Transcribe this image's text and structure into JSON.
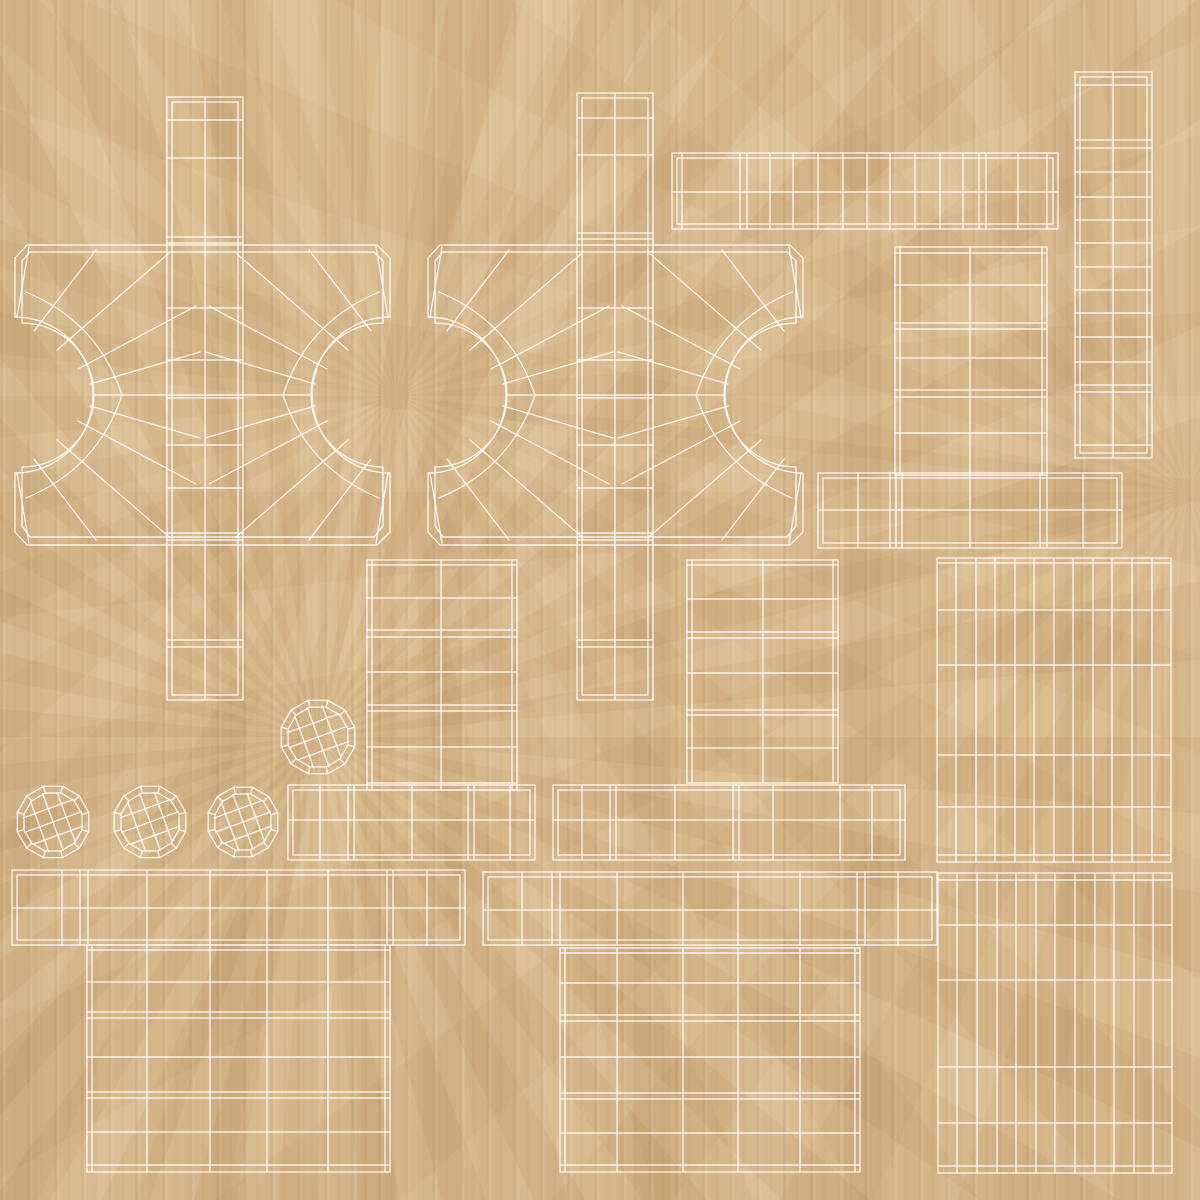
{
  "canvas": {
    "width": 1200,
    "height": 1200
  },
  "palette": {
    "wood_base": "#d8b88b",
    "wood_dark": "#c29b68",
    "wood_light": "#ecd8b0",
    "wire": "#ffffff"
  },
  "wireframe": {
    "stroke_width": 1.2,
    "groups": [
      {
        "name": "uv-strip-vertical-left",
        "els": [
          [
            "rect",
            167,
            97,
            76,
            603
          ],
          [
            "rect",
            172,
            102,
            66,
            593
          ],
          [
            "line",
            205,
            97,
            205,
            700
          ],
          [
            "hlines",
            [
              120,
              158,
              237,
              243,
              308,
              360,
              398,
              445,
              488,
              533,
              540,
              640,
              647
            ],
            167,
            243
          ]
        ]
      },
      {
        "name": "uv-plate-left",
        "els": [
          [
            "path",
            "M 27 245 L 377 245 L 390 258 L 390 317 A 78 78 0 0 0 390 473 L 390 532 L 377 545 L 27 545 L 15 532 L 15 473 A 78 78 0 0 0 15 317 L 15 258 Z"
          ],
          [
            "path",
            "M 30 252 L 374 252 L 383 261 L 383 323 A 72 72 0 0 0 383 467 L 383 526 L 374 537 L 30 537 L 22 526 L 22 467 A 72 72 0 0 0 22 323 L 22 261 Z"
          ],
          [
            "line",
            93,
            395,
            312,
            395
          ],
          [
            "line",
            17,
            317,
            29,
            247
          ],
          [
            "line",
            34,
            331,
            96,
            250
          ],
          [
            "line",
            57,
            350,
            168,
            254
          ],
          [
            "line",
            78,
            369,
            196,
            306
          ],
          [
            "line",
            90,
            384,
            200,
            352
          ],
          [
            "line",
            90,
            406,
            200,
            438
          ],
          [
            "line",
            78,
            421,
            196,
            484
          ],
          [
            "line",
            57,
            440,
            168,
            536
          ],
          [
            "line",
            34,
            459,
            96,
            540
          ],
          [
            "line",
            17,
            473,
            29,
            543
          ],
          [
            "path",
            "M 26 292 Q 98 322 122 395 Q 98 468 26 498"
          ],
          [
            "line",
            388,
            317,
            376,
            247
          ],
          [
            "line",
            371,
            331,
            309,
            250
          ],
          [
            "line",
            348,
            350,
            237,
            254
          ],
          [
            "line",
            327,
            369,
            209,
            306
          ],
          [
            "line",
            315,
            384,
            205,
            352
          ],
          [
            "line",
            315,
            406,
            205,
            438
          ],
          [
            "line",
            327,
            421,
            209,
            484
          ],
          [
            "line",
            348,
            440,
            237,
            536
          ],
          [
            "line",
            371,
            459,
            309,
            540
          ],
          [
            "line",
            388,
            473,
            376,
            543
          ],
          [
            "path",
            "M 379 292 Q 307 322 283 395 Q 307 468 379 498"
          ]
        ]
      },
      {
        "name": "uv-strip-vertical-center",
        "els": [
          [
            "rect",
            577,
            93,
            76,
            607
          ],
          [
            "rect",
            582,
            98,
            66,
            597
          ],
          [
            "line",
            615,
            93,
            615,
            700
          ],
          [
            "hlines",
            [
              118,
              155,
              233,
              239,
              308,
              360,
              398,
              445,
              488,
              533,
              540,
              640,
              647
            ],
            577,
            653
          ]
        ]
      },
      {
        "name": "uv-plate-center",
        "els": [
          [
            "path",
            "M 440 245 L 790 245 L 803 258 L 803 317 A 78 78 0 0 0 803 473 L 803 532 L 790 545 L 440 545 L 428 532 L 428 473 A 78 78 0 0 0 428 317 L 428 258 Z"
          ],
          [
            "path",
            "M 443 252 L 787 252 L 796 261 L 796 323 A 72 72 0 0 0 796 467 L 796 526 L 787 537 L 443 537 L 435 526 L 435 467 A 72 72 0 0 0 435 323 L 435 261 Z"
          ],
          [
            "line",
            506,
            395,
            725,
            395
          ],
          [
            "line",
            430,
            317,
            442,
            247
          ],
          [
            "line",
            447,
            331,
            509,
            250
          ],
          [
            "line",
            470,
            350,
            581,
            254
          ],
          [
            "line",
            491,
            369,
            609,
            306
          ],
          [
            "line",
            503,
            384,
            613,
            352
          ],
          [
            "line",
            503,
            406,
            613,
            438
          ],
          [
            "line",
            491,
            421,
            609,
            484
          ],
          [
            "line",
            470,
            440,
            581,
            536
          ],
          [
            "line",
            447,
            459,
            509,
            540
          ],
          [
            "line",
            430,
            473,
            442,
            543
          ],
          [
            "path",
            "M 439 292 Q 511 322 535 395 Q 511 468 439 498"
          ],
          [
            "line",
            801,
            317,
            789,
            247
          ],
          [
            "line",
            784,
            331,
            722,
            250
          ],
          [
            "line",
            761,
            350,
            650,
            254
          ],
          [
            "line",
            740,
            369,
            622,
            306
          ],
          [
            "line",
            728,
            384,
            618,
            352
          ],
          [
            "line",
            728,
            406,
            618,
            438
          ],
          [
            "line",
            740,
            421,
            622,
            484
          ],
          [
            "line",
            761,
            440,
            650,
            536
          ],
          [
            "line",
            784,
            459,
            722,
            540
          ],
          [
            "line",
            801,
            473,
            789,
            543
          ],
          [
            "path",
            "M 792 292 Q 720 322 696 395 Q 720 468 792 498"
          ]
        ]
      },
      {
        "name": "uv-strip-top-right",
        "els": [
          [
            "rect",
            672,
            153,
            386,
            76
          ],
          [
            "rect",
            677,
            158,
            376,
            66
          ],
          [
            "line",
            672,
            192,
            1058,
            192
          ],
          [
            "vlines",
            [
              682,
              740,
              747,
              770,
              793,
              818,
              843,
              867,
              890,
              915,
              940,
              963,
              979,
              986,
              1018,
              1047
            ],
            153,
            229
          ]
        ]
      },
      {
        "name": "uv-strip-right-tall",
        "els": [
          [
            "rect",
            1075,
            72,
            77,
            386
          ],
          [
            "rect",
            1080,
            77,
            67,
            376
          ],
          [
            "line",
            1113,
            72,
            1113,
            458
          ],
          [
            "hlines",
            [
              85,
              140,
              148,
              172,
              197,
              220,
              243,
              267,
              290,
              313,
              337,
              362,
              385,
              392,
              445
            ],
            1075,
            1152
          ]
        ]
      },
      {
        "name": "uv-rect-right-upper",
        "els": [
          [
            "rect",
            895,
            247,
            152,
            228
          ],
          [
            "line",
            900,
            247,
            900,
            475
          ],
          [
            "line",
            1042,
            247,
            1042,
            475
          ],
          [
            "line",
            895,
            253,
            1047,
            253
          ],
          [
            "line",
            970,
            247,
            970,
            475
          ],
          [
            "hlines",
            [
              285,
              323,
              329,
              358,
              390,
              397,
              433
            ],
            895,
            1047
          ]
        ]
      },
      {
        "name": "uv-strip-right-lower",
        "els": [
          [
            "rect",
            818,
            473,
            304,
            75
          ],
          [
            "rect",
            823,
            478,
            294,
            65
          ],
          [
            "line",
            818,
            510,
            1122,
            510
          ],
          [
            "vlines",
            [
              858,
              890,
              896,
              902,
              970,
              1040,
              1047,
              1083
            ],
            473,
            548
          ]
        ]
      },
      {
        "name": "uv-rect-mid-left",
        "els": [
          [
            "rect",
            367,
            560,
            150,
            230
          ],
          [
            "line",
            372,
            560,
            372,
            790
          ],
          [
            "line",
            512,
            560,
            512,
            790
          ],
          [
            "line",
            367,
            565,
            517,
            565
          ],
          [
            "line",
            441,
            560,
            441,
            790
          ],
          [
            "hlines",
            [
              598,
              630,
              637,
              672,
              705,
              711,
              747,
              783
            ],
            367,
            517
          ]
        ]
      },
      {
        "name": "uv-rect-mid-right",
        "els": [
          [
            "rect",
            687,
            560,
            151,
            223
          ],
          [
            "line",
            692,
            560,
            692,
            783
          ],
          [
            "line",
            833,
            560,
            833,
            783
          ],
          [
            "line",
            687,
            565,
            838,
            565
          ],
          [
            "line",
            763,
            560,
            763,
            783
          ],
          [
            "hlines",
            [
              599,
              632,
              638,
              673,
              710,
              715,
              748
            ],
            687,
            838
          ]
        ]
      },
      {
        "name": "uv-grid-right-upper",
        "els": [
          [
            "rect",
            937,
            558,
            234,
            304
          ],
          [
            "vlines",
            [
              956,
              976,
              995,
              1015,
              1034,
              1054,
              1073,
              1093,
              1112,
              1132,
              1152
            ],
            558,
            862
          ],
          [
            "hlines",
            [
              563,
              610,
              665,
              755,
              807,
              855
            ],
            937,
            1171
          ]
        ]
      },
      {
        "name": "uv-sphere-disc-1",
        "els": [
          [
            "sphere",
            318,
            737,
            38
          ]
        ]
      },
      {
        "name": "uv-sphere-disc-2",
        "els": [
          [
            "sphere",
            53,
            822,
            37
          ]
        ]
      },
      {
        "name": "uv-sphere-disc-3",
        "els": [
          [
            "sphere",
            150,
            822,
            37
          ]
        ]
      },
      {
        "name": "uv-sphere-disc-4",
        "els": [
          [
            "sphere",
            243,
            822,
            36
          ]
        ]
      },
      {
        "name": "uv-bar-mid-left",
        "els": [
          [
            "rect",
            288,
            785,
            247,
            75
          ],
          [
            "rect",
            293,
            790,
            237,
            65
          ],
          [
            "line",
            288,
            820,
            535,
            820
          ],
          [
            "vlines",
            [
              320,
              348,
              354,
              412,
              468,
              474,
              510
            ],
            785,
            860
          ]
        ]
      },
      {
        "name": "uv-bar-mid-right",
        "els": [
          [
            "rect",
            553,
            785,
            352,
            75
          ],
          [
            "rect",
            558,
            790,
            342,
            65
          ],
          [
            "line",
            553,
            820,
            905,
            820
          ],
          [
            "vlines",
            [
              582,
              610,
              616,
              675,
              733,
              739,
              773,
              840,
              872
            ],
            785,
            860
          ]
        ]
      },
      {
        "name": "uv-bar-bottom-left",
        "els": [
          [
            "rect",
            12,
            870,
            453,
            75
          ],
          [
            "rect",
            17,
            875,
            443,
            65
          ],
          [
            "line",
            12,
            908,
            465,
            908
          ],
          [
            "vlines",
            [
              62,
              80,
              88,
              147,
              210,
              267,
              328,
              387,
              393,
              427
            ],
            870,
            945
          ]
        ]
      },
      {
        "name": "uv-rect-bottom-left",
        "els": [
          [
            "rect",
            87,
            945,
            303,
            227
          ],
          [
            "line",
            92,
            945,
            92,
            1172
          ],
          [
            "line",
            385,
            945,
            385,
            1172
          ],
          [
            "line",
            87,
            950,
            390,
            950
          ],
          [
            "line",
            87,
            1165,
            390,
            1165
          ],
          [
            "vlines",
            [
              147,
              210,
              267,
              328
            ],
            945,
            1172
          ],
          [
            "hlines",
            [
              982,
              1012,
              1018,
              1057,
              1092,
              1098,
              1132
            ],
            87,
            390
          ]
        ]
      },
      {
        "name": "uv-bar-bottom-middle",
        "els": [
          [
            "rect",
            483,
            872,
            454,
            73
          ],
          [
            "rect",
            488,
            877,
            444,
            63
          ],
          [
            "line",
            483,
            910,
            937,
            910
          ],
          [
            "vlines",
            [
              522,
              552,
              560,
              617,
              683,
              738,
              800,
              857,
              865,
              898
            ],
            872,
            945
          ]
        ]
      },
      {
        "name": "uv-rect-bottom-middle",
        "els": [
          [
            "rect",
            560,
            948,
            300,
            224
          ],
          [
            "line",
            565,
            948,
            565,
            1172
          ],
          [
            "line",
            855,
            948,
            855,
            1172
          ],
          [
            "line",
            560,
            953,
            860,
            953
          ],
          [
            "line",
            560,
            1165,
            860,
            1165
          ],
          [
            "vlines",
            [
              617,
              683,
              738,
              800
            ],
            948,
            1172
          ],
          [
            "hlines",
            [
              983,
              1015,
              1021,
              1057,
              1093,
              1099,
              1133
            ],
            560,
            860
          ]
        ]
      },
      {
        "name": "uv-grid-bottom-right",
        "els": [
          [
            "rect",
            938,
            873,
            234,
            300
          ],
          [
            "vlines",
            [
              957,
              977,
              997,
              1016,
              1036,
              1055,
              1075,
              1095,
              1114,
              1134,
              1153
            ],
            873,
            1173
          ],
          [
            "hlines",
            [
              880,
              925,
              980,
              1067,
              1123,
              1166
            ],
            938,
            1172
          ]
        ]
      }
    ]
  }
}
